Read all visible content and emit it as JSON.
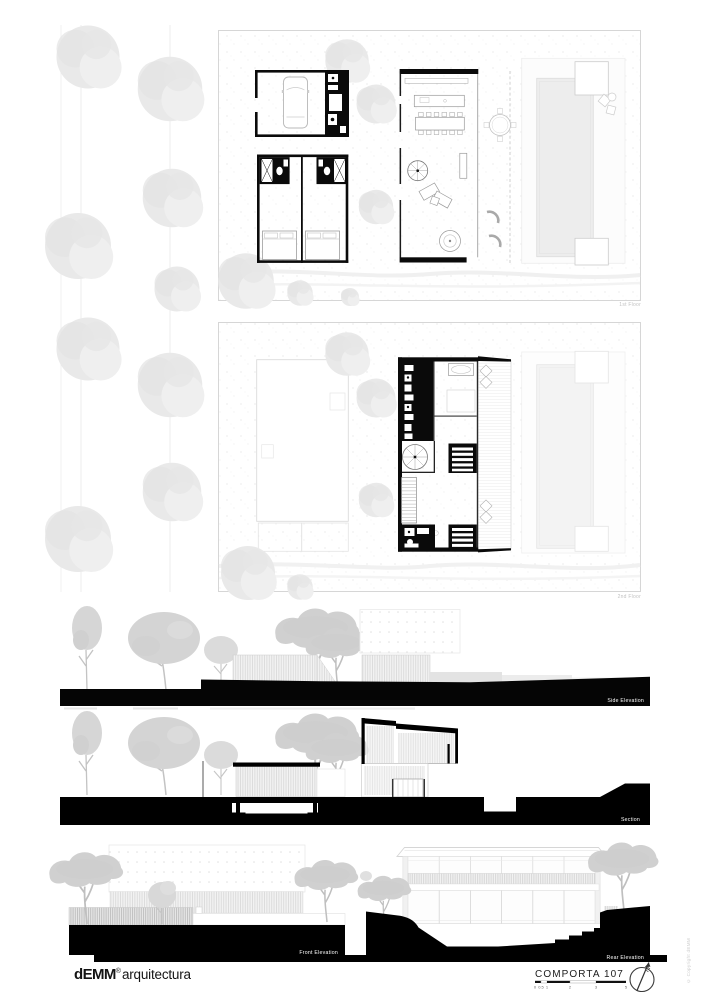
{
  "panels": {
    "first_floor": {
      "label": "1st Floor"
    },
    "second_floor": {
      "label": "2nd Floor"
    },
    "side_elevation": {
      "label": "Side Elevation"
    },
    "section": {
      "label": "Section"
    },
    "front_elevation": {
      "label": "Front Elevation"
    },
    "rear_elevation": {
      "label": "Rear Elevation"
    }
  },
  "footer": {
    "logo": {
      "brand": "dEMM",
      "registered": "®",
      "studio": "arquitectura"
    },
    "project_title": "COMPORTA 107",
    "scale_bar": {
      "marks": [
        "0",
        "0.5",
        "1",
        "2",
        "3",
        "5"
      ]
    },
    "copyright": "© Copyright dEMM"
  },
  "colors": {
    "paper": "#ffffff",
    "ink": "#0a0a0a",
    "elevation_tree": "#d2d2d2",
    "plan_tree": "#e8e8e8",
    "ghost_line": "#dddddd",
    "floor_label": "#c2c2c2"
  }
}
